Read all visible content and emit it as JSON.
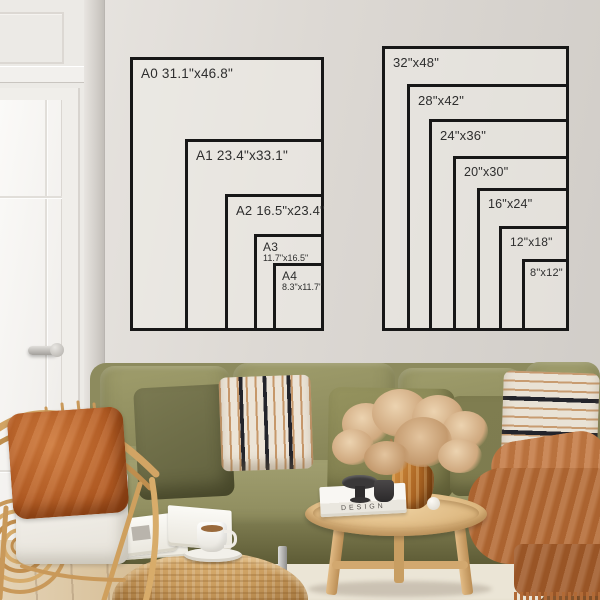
{
  "meta": {
    "description": "Poster size guide mockup drawn on a wall above a sofa"
  },
  "size_guide": {
    "a_series": {
      "name": "A-series sizes",
      "items": [
        {
          "name": "A0",
          "dims": "31.1\"x46.8\"",
          "width_in": 31.1,
          "height_in": 46.8
        },
        {
          "name": "A1",
          "dims": "23.4\"x33.1\"",
          "width_in": 23.4,
          "height_in": 33.1
        },
        {
          "name": "A2",
          "dims": "16.5\"x23.4\"",
          "width_in": 16.5,
          "height_in": 23.4
        },
        {
          "name": "A3",
          "dims": "11.7\"x16.5\"",
          "width_in": 11.7,
          "height_in": 16.5
        },
        {
          "name": "A4",
          "dims": "8.3\"x11.7\"",
          "width_in": 8.3,
          "height_in": 11.7
        }
      ]
    },
    "inch_series": {
      "name": "Inch sizes",
      "items": [
        {
          "label": "32\"x48\"",
          "width_in": 32,
          "height_in": 48
        },
        {
          "label": "28\"x42\"",
          "width_in": 28,
          "height_in": 42
        },
        {
          "label": "24\"x36\"",
          "width_in": 24,
          "height_in": 36
        },
        {
          "label": "20\"x30\"",
          "width_in": 20,
          "height_in": 30
        },
        {
          "label": "16\"x24\"",
          "width_in": 16,
          "height_in": 24
        },
        {
          "label": "12\"x18\"",
          "width_in": 12,
          "height_in": 18
        },
        {
          "label": "8\"x12\"",
          "width_in": 8,
          "height_in": 12
        }
      ]
    },
    "scale_note": "Sofa is 84\"/213cm wide"
  },
  "scene": {
    "book_title": "DESIGN"
  },
  "colors": {
    "line": "#171717",
    "wall": "#dcd8d3",
    "sofa_olive": "#8d8b5e",
    "accent_rust": "#b46a34",
    "rattan": "#cfa160"
  }
}
